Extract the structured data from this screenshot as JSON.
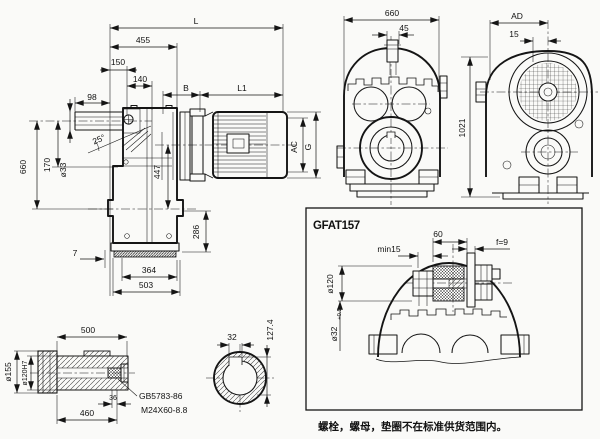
{
  "note": "螺栓，螺母，垫圈不在标准供货范围内。",
  "detail_box": {
    "title": "GFAT157",
    "w60": "60",
    "min15": "min15",
    "f9": "f=9",
    "d120": "ø120",
    "d32": "ø32",
    "d32_tol": "+0.5"
  },
  "side_view": {
    "L": "L",
    "len455": "455",
    "len150": "150",
    "len140": "140",
    "B": "B",
    "L1": "L1",
    "len98": "98",
    "h660": "660",
    "h170": "170",
    "d33": "ø33",
    "ang25": "25°",
    "h447": "447",
    "h286": "286",
    "off7": "7",
    "w364": "364",
    "w503": "503",
    "AC": "AC",
    "G": "G"
  },
  "front_view": {
    "w660": "660",
    "w45": "45",
    "h1021": "1021"
  },
  "input_view": {
    "AD": "AD",
    "w15": "15"
  },
  "shaft_detail": {
    "len500": "500",
    "d155": "ø155",
    "d120h7": "ø120H7",
    "len36": "36",
    "len460": "460",
    "std": "GB5783-86",
    "bolt": "M24X60-8.8"
  },
  "section_view": {
    "w32": "32",
    "h127": "127.4"
  }
}
